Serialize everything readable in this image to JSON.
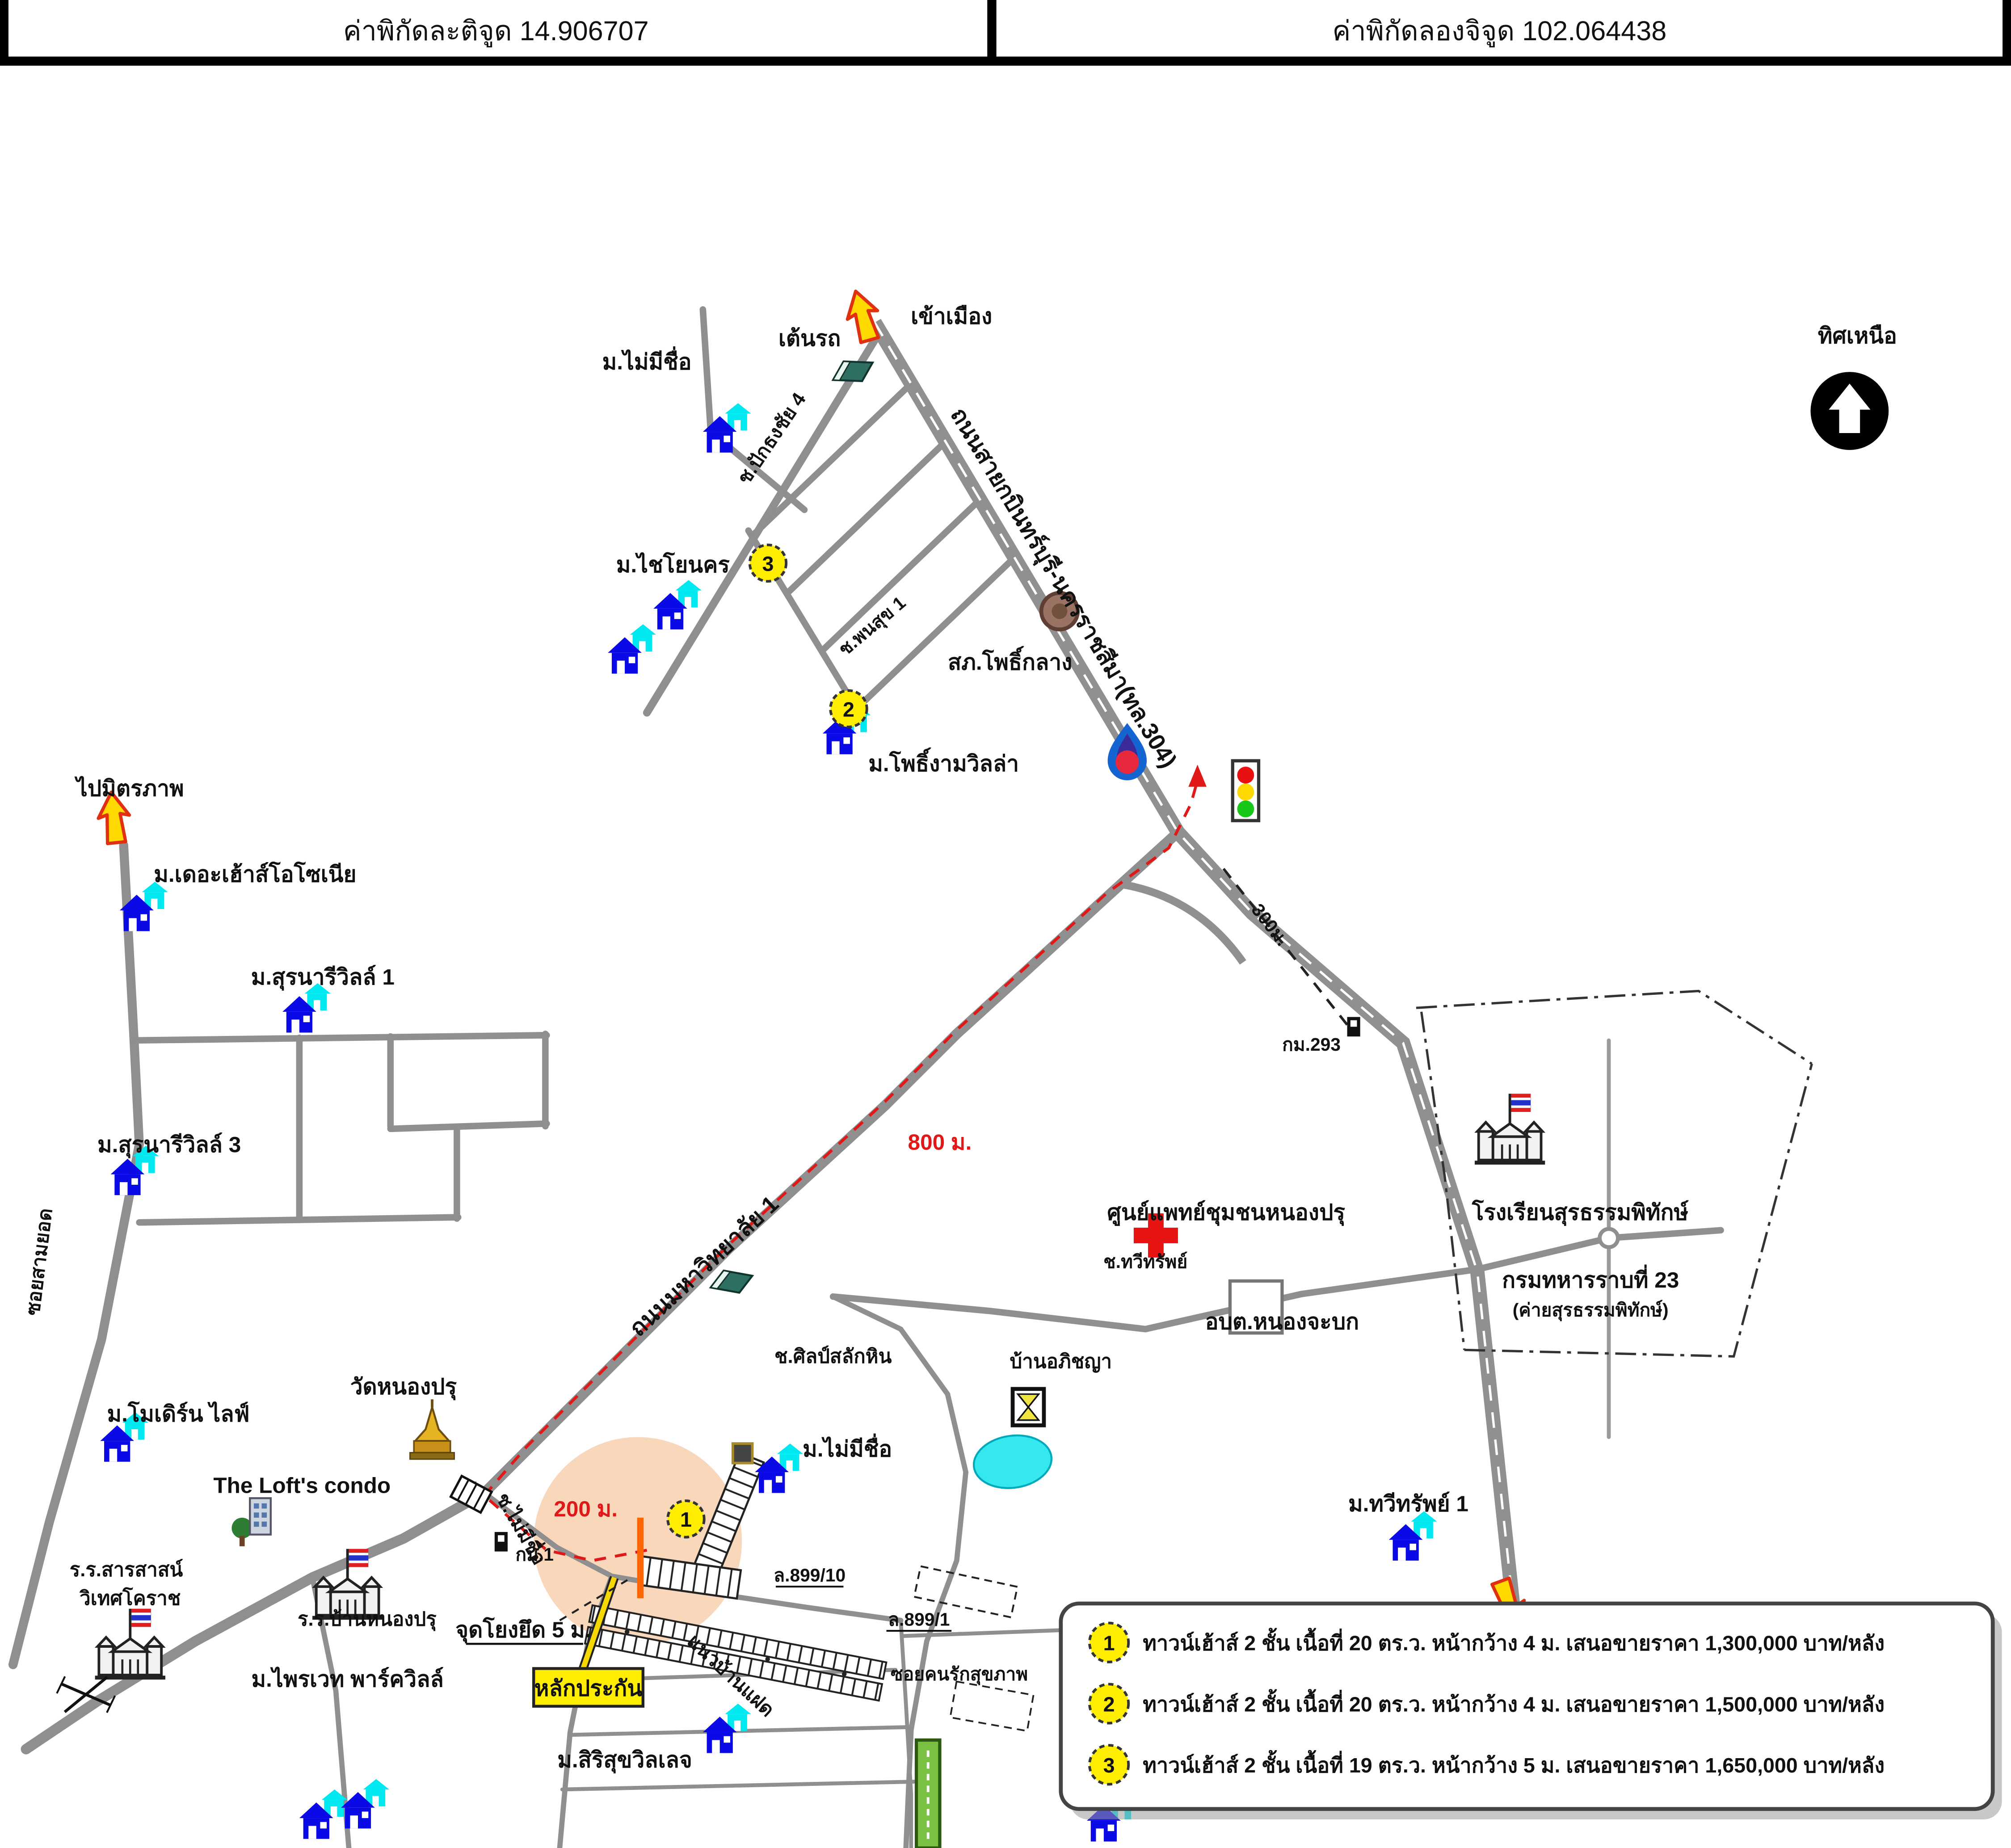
{
  "header": {
    "latitude": "ค่าพิกัดละติจูด 14.906707",
    "longitude": "ค่าพิกัดลองจิจูด 102.064438"
  },
  "compass": {
    "label": "ทิศเหนือ"
  },
  "colors": {
    "road_gray": "#8f8f8f",
    "route_red": "#e01818",
    "highlight_peach": "#f8d7bb",
    "marker_yellow": "#ffee00",
    "arrow_yellow": "#ffd900",
    "house_blue": "#0a0ae6",
    "house_cyan": "#00e8f0"
  },
  "map": {
    "labels": {
      "enter_city": "เข้าเมือง",
      "car_tent": "เต้นรถ",
      "no_name_village_top": "ม.ไม่มีชื่อ",
      "soi_pak_thong_chai_4": "ช.ปักธงชัย 4",
      "chaiyo_nakhon": "ม.ไชโยนคร",
      "soi_phon_suk_1": "ช.พนสุข 1",
      "police_pho_klang": "สภ.โพธิ์กลาง",
      "pho_ngam_villa": "ม.โพธิ์งามวิลล่า",
      "highway": "ถนนสายกบินทร์บุรี-นครราชสีมา(ทล.304)",
      "to_mittraphap": "ไปมิตรภาพ",
      "the_house_ozonia": "ม.เดอะเฮ้าส์โอโซเนีย",
      "suranari_ville_1": "ม.สุรนารีวิลล์ 1",
      "suranari_ville_3": "ม.สุรนารีวิลล์ 3",
      "soi_sam_yot": "ซอยสามยอด",
      "dist_800": "800 ม.",
      "university_road": "ถนนมหาวิทยาลัย 1",
      "dist_300": "300ม.",
      "km_293": "กม.293",
      "medical_center": "ศูนย์แพทย์ชุมชนหนองปรุ",
      "soi_thawi_sap": "ช.ทวีทรัพย์",
      "obt_nong_chabok": "อบต.หนองจะบก",
      "surathampitak_school": "โรงเรียนสุรธรรมพิทักษ์",
      "infantry_23": "กรมทหารราบที่ 23",
      "infantry_23_sub": "(ค่ายสุรธรรมพิทักษ์)",
      "baan_apichaya": "บ้านอภิชญา",
      "soi_silp_salak_hin": "ช.ศิลป์สลักหิน",
      "wat_nong_pru": "วัดหนองปรุ",
      "modern_life": "ม.โมเดิร์น ไลฟ์",
      "lofts_condo": "The Loft's condo",
      "km_1": "กม.1",
      "sarasas_line1": "ร.ร.สารสาสน์",
      "sarasas_line2": "วิเทศโคราช",
      "baan_nong_pru_school": "ร.ร.บ้านหนองปรุ",
      "private_park_ville": "ม.ไพรเวท พาร์ควิลล์",
      "collateral": "หลักประกัน",
      "tie_point": "จุดโยงยึด 5 ม.",
      "soi_no_name": "ช.ไม่มีชื่อ",
      "dist_200": "200 ม.",
      "no_name_village_center": "ม.ไม่มีชื่อ",
      "l_899_10": "ล.899/10",
      "l_899_1": "ล.899/1",
      "soi_khon_rak_sukkhaphap": "ซอยคนรักสุขภาพ",
      "twin_house_row": "แนวบ้านแฝด",
      "sirisuk_village": "ม.สิริสุขวิลเลจ",
      "thawi_sap_1": "ม.ทวีทรัพย์ 1"
    },
    "markers": {
      "m1": "1",
      "m2": "2",
      "m3": "3"
    }
  },
  "legend": {
    "items": [
      {
        "no": "1",
        "text": "ทาวน์เฮ้าส์ 2 ชั้น เนื้อที่  20  ตร.ว.  หน้ากว้าง 4 ม. เสนอขายราคา  1,300,000  บาท/หลัง"
      },
      {
        "no": "2",
        "text": "ทาวน์เฮ้าส์ 2 ชั้น เนื้อที่  20  ตร.ว. หน้ากว้าง 4 ม. เสนอขายราคา  1,500,000  บาท/หลัง"
      },
      {
        "no": "3",
        "text": "ทาวน์เฮ้าส์ 2 ชั้น เนื้อที่  19  ตร.ว. หน้ากว้าง 5 ม. เสนอขายราคา  1,650,000  บาท/หลัง"
      }
    ]
  }
}
